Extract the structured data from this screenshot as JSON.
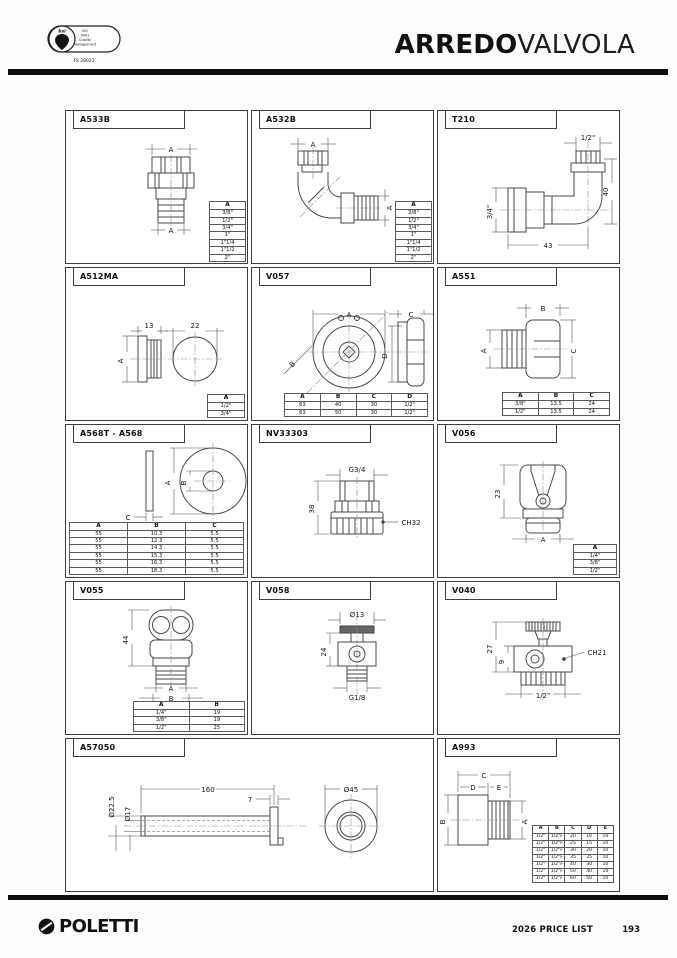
{
  "header": {
    "title_bold": "ARREDO",
    "title_light": "VALVOLA",
    "badge": {
      "brand": "bsi",
      "lines": [
        "ISO",
        "9001",
        "Quality",
        "Management"
      ],
      "cert_number": "FS 28021"
    }
  },
  "footer": {
    "brand": "POLETTI",
    "price_list_label": "2026 PRICE LIST",
    "page_number": "193"
  },
  "cells": [
    {
      "code": "A533B",
      "dims": {
        "top": "A",
        "bottom": "A"
      },
      "table": {
        "headers": [
          "A"
        ],
        "rows": [
          [
            "3/8\""
          ],
          [
            "1/2\""
          ],
          [
            "3/4\""
          ],
          [
            "1\""
          ],
          [
            "1\"1/4"
          ],
          [
            "1\"1/2"
          ],
          [
            "2\""
          ]
        ]
      }
    },
    {
      "code": "A532B",
      "dims": {
        "top": "A",
        "right": "A"
      },
      "table": {
        "headers": [
          "A"
        ],
        "rows": [
          [
            "3/8\""
          ],
          [
            "1/2\""
          ],
          [
            "3/4\""
          ],
          [
            "1\""
          ],
          [
            "1\"1/4"
          ],
          [
            "1\"1/2"
          ],
          [
            "2\""
          ]
        ]
      }
    },
    {
      "code": "T210",
      "dims": {
        "top": "1/2\"",
        "right": "40",
        "left": "3/4\"",
        "bottom": "43"
      },
      "table": null
    },
    {
      "code": "A512MA",
      "dims": {
        "width_flange": "13",
        "width_circle": "22",
        "left": "A"
      },
      "table": {
        "headers": [
          "A"
        ],
        "rows": [
          [
            "1/2\""
          ],
          [
            "3/4\""
          ]
        ]
      }
    },
    {
      "code": "V057",
      "dims": {
        "front_width": "A",
        "diagonal": "B",
        "side_width": "C",
        "side_height": "D"
      },
      "table": {
        "headers": [
          "A",
          "B",
          "C",
          "D"
        ],
        "rows": [
          [
            "63",
            "40",
            "30",
            "1/2\""
          ],
          [
            "63",
            "50",
            "30",
            "1/2\""
          ]
        ]
      }
    },
    {
      "code": "A551",
      "dims": {
        "left": "A",
        "top": "B",
        "right": "C"
      },
      "table": {
        "headers": [
          "A",
          "B",
          "C"
        ],
        "rows": [
          [
            "3/8\"",
            "13.5",
            "24"
          ],
          [
            "1/2\"",
            "13.5",
            "24"
          ]
        ]
      }
    },
    {
      "code": "A568T - A568",
      "dims": {
        "thickness": "C",
        "outer_dia": "A",
        "inner_dia": "B"
      },
      "table": {
        "headers": [
          "A",
          "B",
          "C"
        ],
        "rows": [
          [
            "55",
            "10.3",
            "5.5"
          ],
          [
            "55",
            "12.3",
            "5.5"
          ],
          [
            "55",
            "14.3",
            "5.5"
          ],
          [
            "55",
            "15.3",
            "5.5"
          ],
          [
            "55",
            "16.3",
            "5.5"
          ],
          [
            "55",
            "18.3",
            "5.5"
          ]
        ]
      }
    },
    {
      "code": "NV33303",
      "dims": {
        "thread": "G3/4",
        "height": "38",
        "wrench": "CH32"
      },
      "table": null
    },
    {
      "code": "V056",
      "dims": {
        "height": "23",
        "bottom": "A"
      },
      "table": {
        "headers": [
          "A"
        ],
        "rows": [
          [
            "1/4\""
          ],
          [
            "3/8\""
          ],
          [
            "1/2\""
          ]
        ]
      }
    },
    {
      "code": "V055",
      "dims": {
        "height": "44",
        "dim_a": "A",
        "dim_b": "B"
      },
      "table": {
        "headers": [
          "A",
          "B"
        ],
        "rows": [
          [
            "1/4\"",
            "19"
          ],
          [
            "3/8\"",
            "19"
          ],
          [
            "1/2\"",
            "25"
          ]
        ]
      }
    },
    {
      "code": "V058",
      "dims": {
        "top_dia": "Ø13",
        "height": "24",
        "thread": "G1/8"
      },
      "table": null
    },
    {
      "code": "V040",
      "dims": {
        "height_total": "27",
        "height_body": "9",
        "wrench": "CH21",
        "thread": "1/2\""
      },
      "table": null
    },
    {
      "code": "A57050",
      "dims": {
        "outer_dia": "Ø22.5",
        "inner_dia": "Ø17",
        "length": "160",
        "flange_thickness": "7",
        "flange_dia": "Ø45"
      },
      "table": null
    },
    {
      "code": "A993",
      "dims": {
        "dim_c": "C",
        "dim_d": "D",
        "dim_e": "E",
        "dim_b": "B",
        "dim_a": "A"
      },
      "table": {
        "headers": [
          "A",
          "B",
          "C",
          "D",
          "E"
        ],
        "rows": [
          [
            "1/2\"",
            "1/2\"F",
            "20",
            "10",
            "10"
          ],
          [
            "1/2\"",
            "1/2\"F",
            "25",
            "15",
            "10"
          ],
          [
            "1/2\"",
            "1/2\"F",
            "30",
            "20",
            "10"
          ],
          [
            "1/2\"",
            "1/2\"F",
            "35",
            "25",
            "10"
          ],
          [
            "1/2\"",
            "1/2\"F",
            "40",
            "30",
            "10"
          ],
          [
            "1/2\"",
            "1/2\"F",
            "50",
            "40",
            "10"
          ],
          [
            "1/2\"",
            "1/2\"F",
            "60",
            "50",
            "10"
          ]
        ]
      }
    }
  ]
}
